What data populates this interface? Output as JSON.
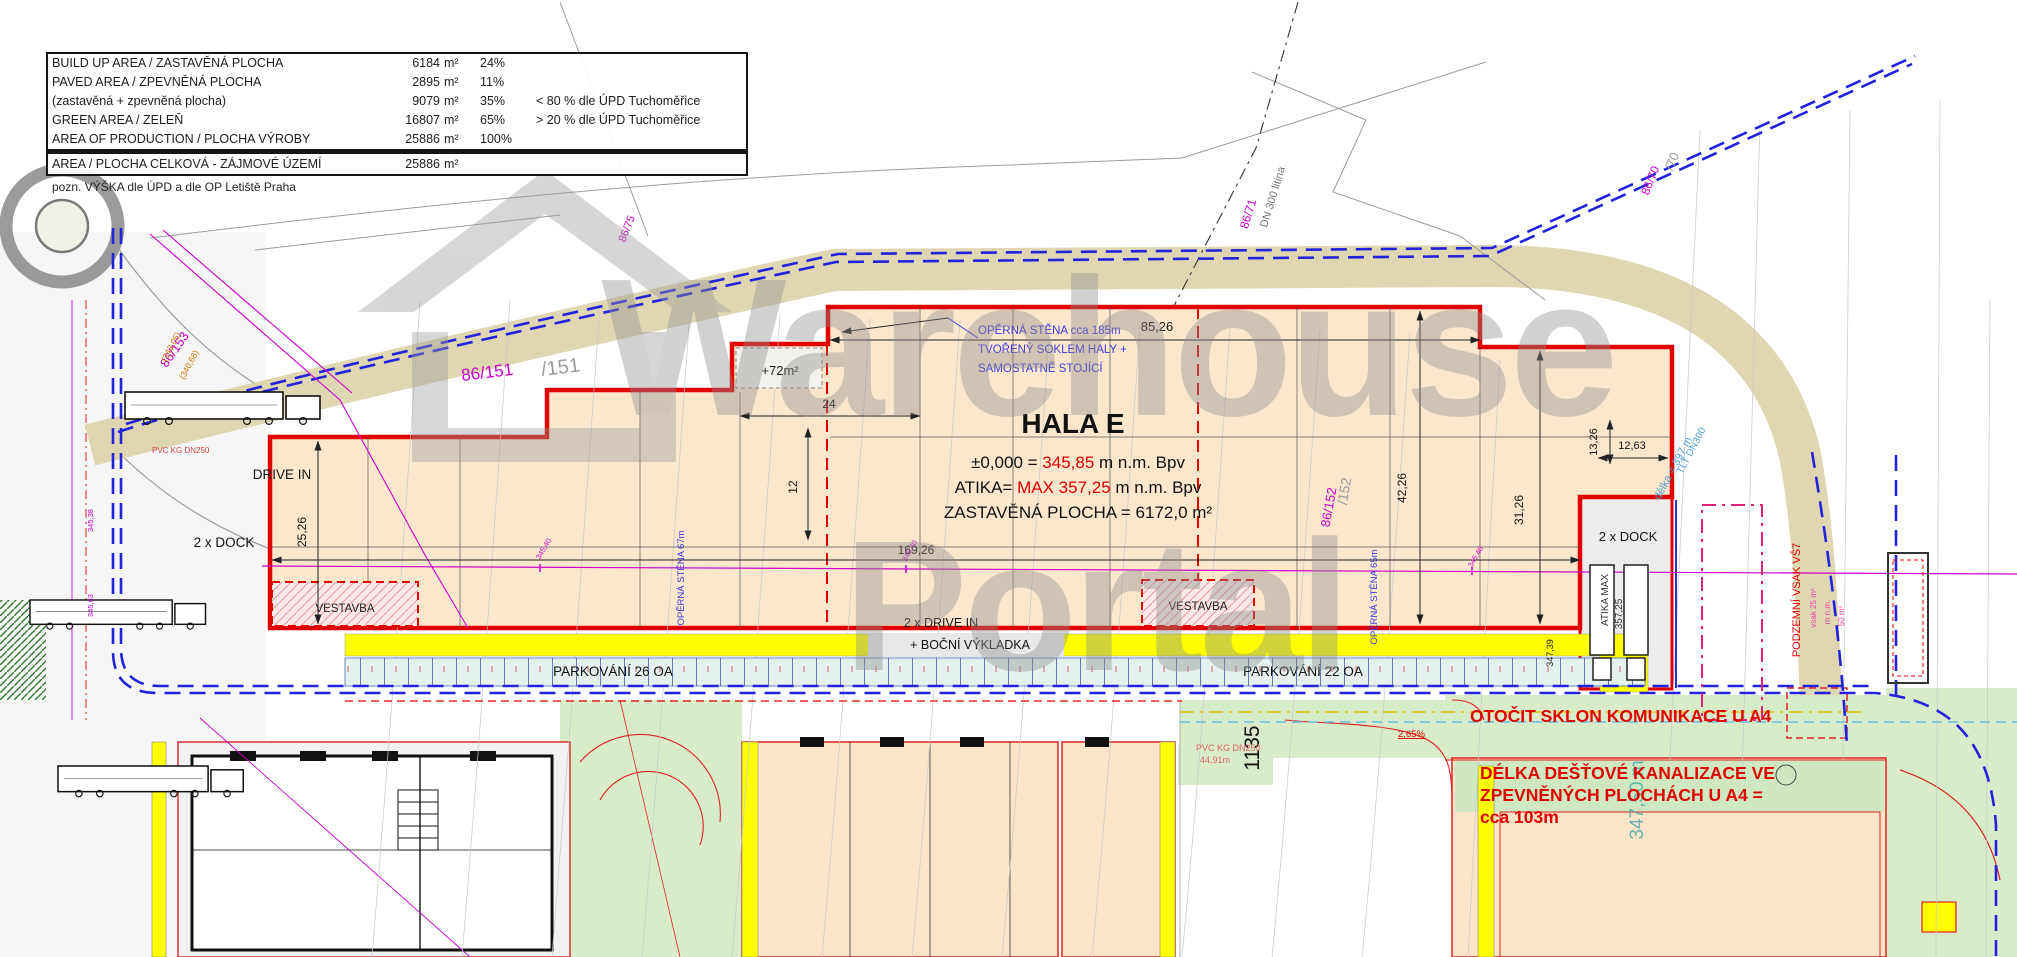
{
  "watermark": {
    "line1": "Warehouse",
    "line2": "Portal"
  },
  "area_table": {
    "rows": [
      {
        "label": "BUILD UP AREA / ZASTAVĚNÁ PLOCHA",
        "value": "6184",
        "unit": "m²",
        "pct": "24%",
        "note": ""
      },
      {
        "label": "PAVED AREA / ZPEVNĚNÁ PLOCHA",
        "value": "2895",
        "unit": "m²",
        "pct": "11%",
        "note": ""
      },
      {
        "label": "(zastavěná + zpevněná plocha)",
        "value": "9079",
        "unit": "m²",
        "pct": "35%",
        "note": "< 80 % dle  ÚPD Tuchoměřice"
      },
      {
        "label": "GREEN AREA / ZELEŇ",
        "value": "16807",
        "unit": "m²",
        "pct": "65%",
        "note": "> 20 % dle  ÚPD Tuchoměřice"
      },
      {
        "label": "AREA OF PRODUCTION / PLOCHA VÝROBY",
        "value": "25886",
        "unit": "m²",
        "pct": "100%",
        "note": ""
      }
    ],
    "total": {
      "label": "AREA / PLOCHA CELKOVÁ - ZÁJMOVÉ ÚZEMÍ",
      "value": "25886",
      "unit": "m²"
    },
    "footnote": "pozn. VÝŠKA  dle  ÚPD a dle OP Letiště Praha"
  },
  "hall": {
    "title": "HALA E",
    "level_prefix": "±0,000 = ",
    "level_value": "345,85",
    "level_suffix": " m n.m. Bpv",
    "atika_prefix": "ATIKA= ",
    "atika_value": "MAX 357,25",
    "atika_suffix": " m n.m. Bpv",
    "footprint": "ZASTAVĚNÁ PLOCHA = 6172,0 m²",
    "annex_area": "+72m²"
  },
  "labels": {
    "drive_in": "DRIVE IN",
    "dock_left": "2 x DOCK",
    "dock_right": "2 x DOCK",
    "vestavba_left": "VESTAVBA",
    "vestavba_right": "VESTAVBA",
    "drive_in_double": "2 x DRIVE IN",
    "side_unloading": "+ BOČNÍ VÝKLADKA",
    "parking_left": "PARKOVÁNÍ 26 OA",
    "parking_right": "PARKOVÁNÍ 22 OA",
    "atika_max_1": "ATIKA MAX",
    "atika_max_2": "357,25"
  },
  "annotations": {
    "wall_note_1": "OPĚRNÁ STĚNA cca 185m",
    "wall_note_2": "TVOŘENÝ SOKLEM HALY +",
    "wall_note_3": "SAMOSTATNĚ STOJÍCÍ",
    "wall_67": "OPĚRNÁ STĚNA 67m",
    "wall_65": "OPĚRNÁ STĚNA 65m",
    "slope_note": "OTOČIT SKLON KOMUNIKACE U A4",
    "rain_note_1": "DÉLKA DEŠŤOVÉ KANALIZACE VE",
    "rain_note_2": "ZPEVNĚNÝCH PLOCHÁCH U A4 =",
    "rain_note_3": "cca 103m",
    "soak_title": "PODZEMNÍ VSAK VŠ7",
    "soak_sub_1": "vsak 25 m³",
    "soak_sub_2": "m n.m.",
    "soak_sub_3": "50 m³",
    "pipe_length": "délka = 397 m",
    "pipe_type": "TLT DN300",
    "pipe_cast": "DN 300 litina",
    "pvc_note_1": "PVC KG DN250",
    "pvc_note_2": "44,91m",
    "pvc_left": "PVC KG DN250",
    "slope_pct": "2,65%"
  },
  "parcels": {
    "p86_153": "86/153",
    "p86_151": "86/151",
    "p151": "/151",
    "p86_152": "86/152",
    "p152": "/152",
    "p86_75": "86/75",
    "p86_71": "86/71",
    "p86_70": "86/70",
    "p70": "/70"
  },
  "dims": {
    "d85": "85,26",
    "d24": "24",
    "d12": "12",
    "d25": "25,26",
    "d169": "169,26",
    "d42": "42,26",
    "d31": "31,26",
    "d13": "13,26",
    "d12_63": "12,63",
    "d347_39": "347,39",
    "d1135": "1135",
    "d347_50": "347,50 m"
  },
  "elevations": {
    "e345_40": "345,40",
    "e345_38": "345,38",
    "e345_63": "345,63",
    "e343": "(343,05)",
    "e340": "(340,68)"
  },
  "colors": {
    "hall_fill": "#fce7cd",
    "outline_red": "#e00000",
    "boundary_blue": "#2222dd",
    "magenta": "#cc00cc",
    "yellow": "#ffff00",
    "parking_fill": "#e4f1ee",
    "green_fill": "#d9ecca",
    "road_tan": "#d9d0a5",
    "annotation_blue": "#3a3ae0",
    "watermark_gray": "#8a8a8a"
  }
}
